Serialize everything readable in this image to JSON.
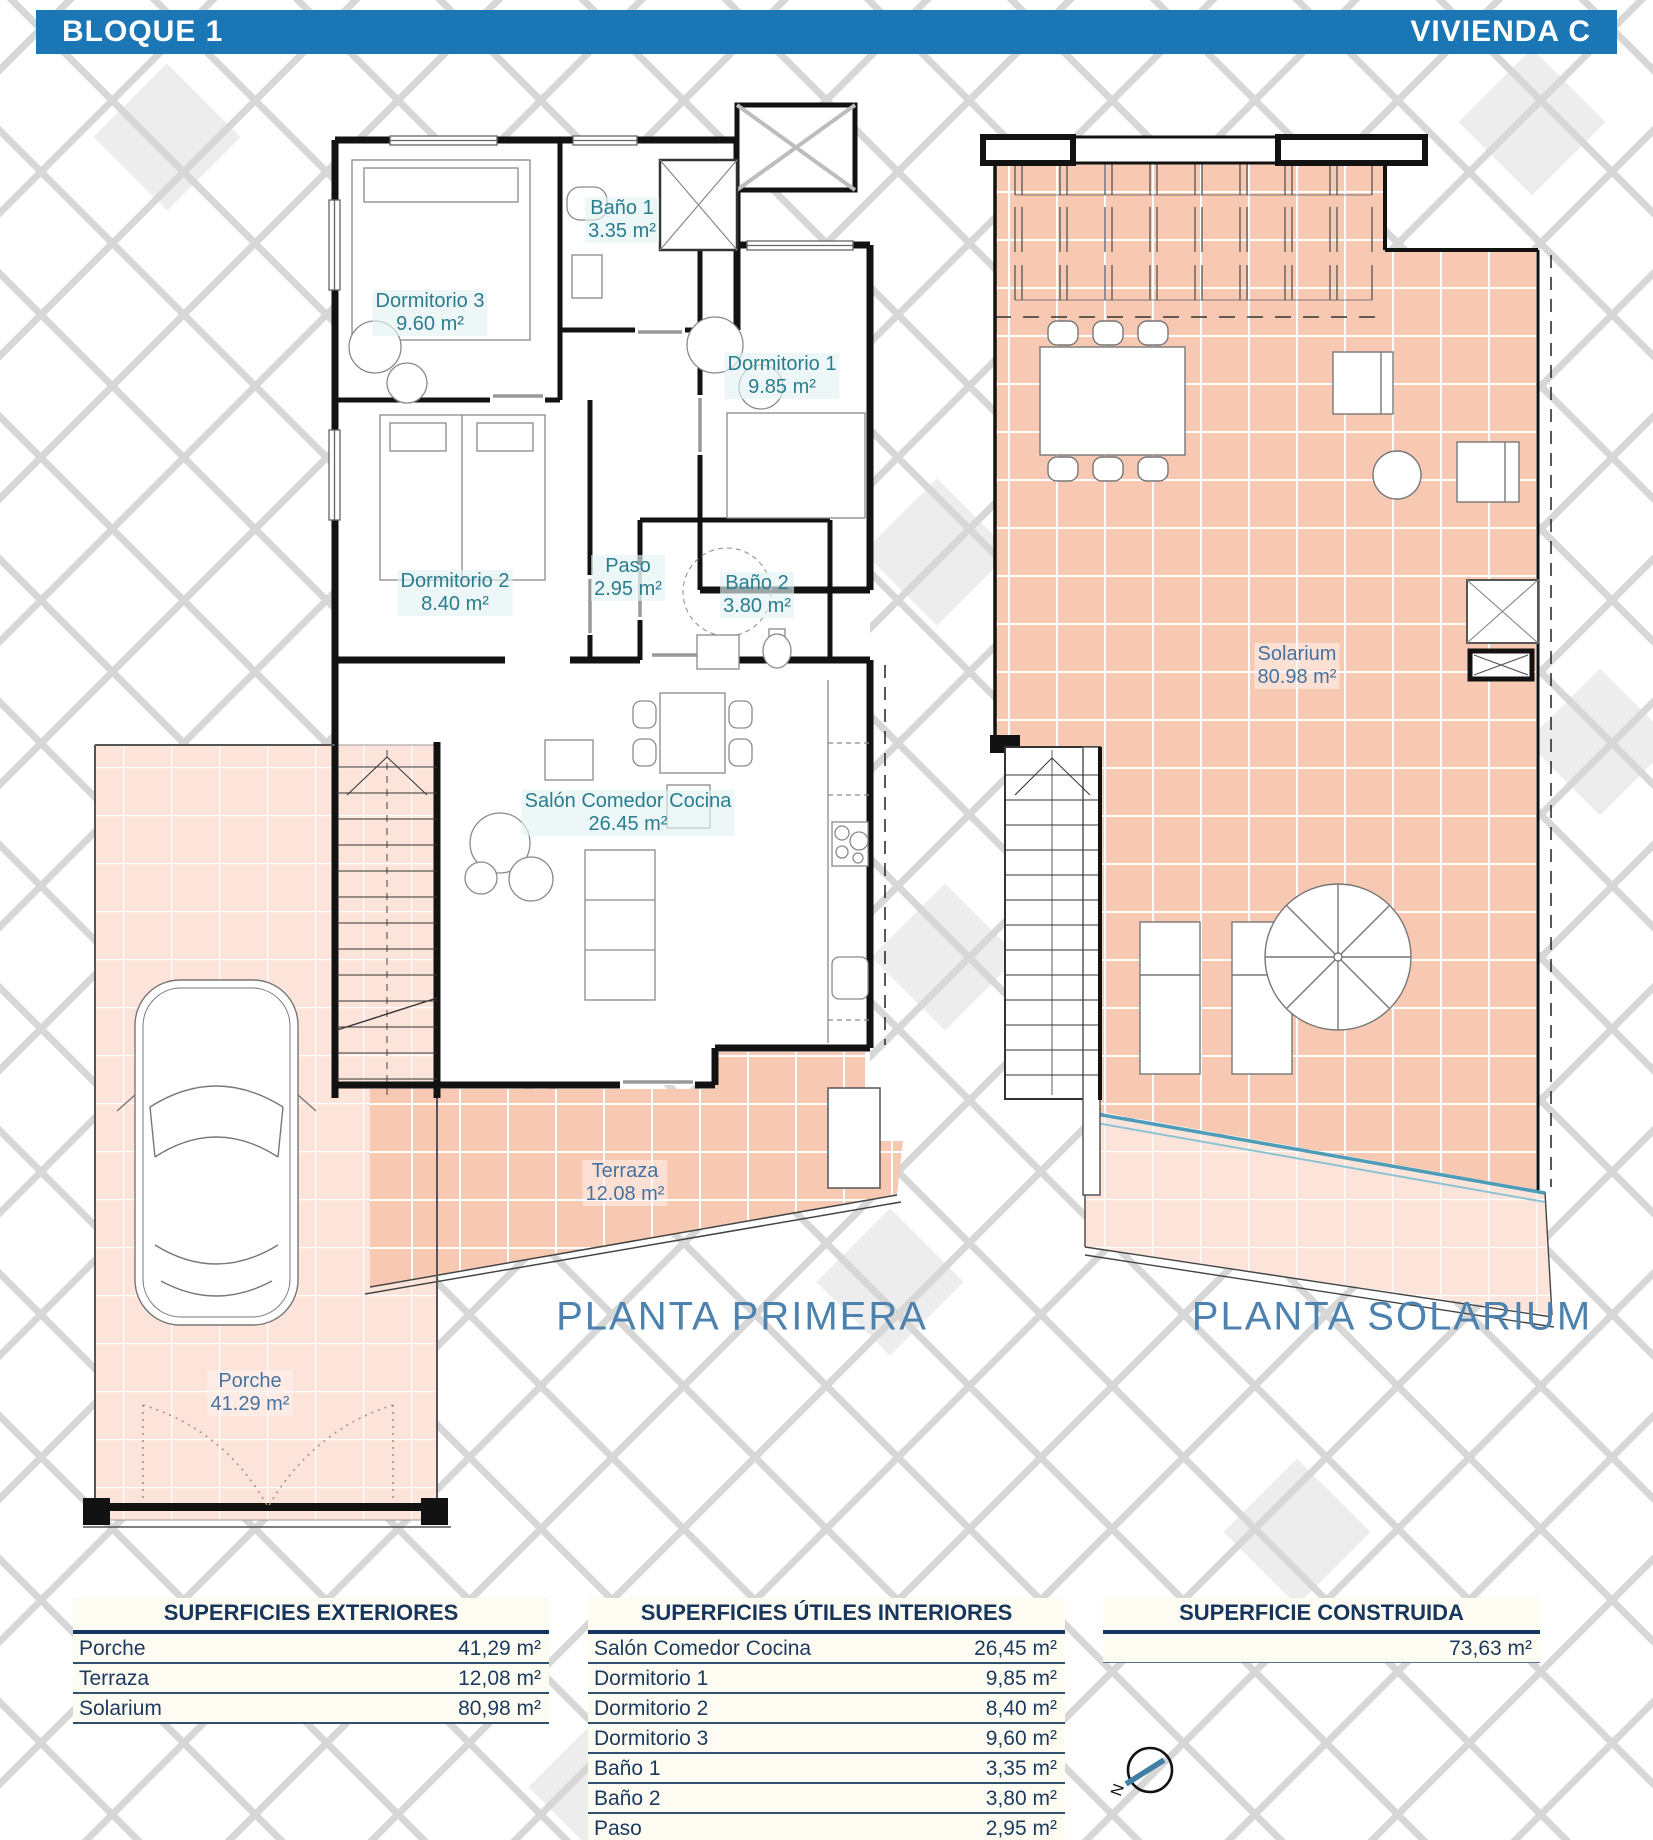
{
  "header": {
    "left": "BLOQUE 1",
    "right": "VIVIENDA C"
  },
  "plan_primera": {
    "title": "PLANTA PRIMERA",
    "rooms": {
      "bano1": {
        "name": "Baño 1",
        "area": "3.35 m²"
      },
      "dormitorio3": {
        "name": "Dormitorio 3",
        "area": "9.60 m²"
      },
      "dormitorio1": {
        "name": "Dormitorio 1",
        "area": "9.85 m²"
      },
      "dormitorio2": {
        "name": "Dormitorio 2",
        "area": "8.40 m²"
      },
      "paso": {
        "name": "Paso",
        "area": "2.95 m²"
      },
      "bano2": {
        "name": "Baño 2",
        "area": "3.80 m²"
      },
      "salon": {
        "name": "Salón Comedor Cocina",
        "area": "26.45 m²"
      },
      "terraza": {
        "name": "Terraza",
        "area": "12.08 m²"
      },
      "porche": {
        "name": "Porche",
        "area": "41.29 m²"
      }
    }
  },
  "plan_solarium": {
    "title": "PLANTA SOLARIUM",
    "rooms": {
      "solarium": {
        "name": "Solarium",
        "area": "80.98 m²"
      }
    }
  },
  "tables": {
    "exteriores": {
      "title": "SUPERFICIES EXTERIORES",
      "rows": [
        {
          "label": "Porche",
          "value": "41,29 m²"
        },
        {
          "label": "Terraza",
          "value": "12,08 m²"
        },
        {
          "label": "Solarium",
          "value": "80,98 m²"
        }
      ]
    },
    "interiores": {
      "title": "SUPERFICIES ÚTILES INTERIORES",
      "rows": [
        {
          "label": "Salón Comedor Cocina",
          "value": "26,45 m²"
        },
        {
          "label": "Dormitorio 1",
          "value": "9,85 m²"
        },
        {
          "label": "Dormitorio 2",
          "value": "8,40 m²"
        },
        {
          "label": "Dormitorio 3",
          "value": "9,60 m²"
        },
        {
          "label": "Baño 1",
          "value": "3,35 m²"
        },
        {
          "label": "Baño 2",
          "value": "3,80 m²"
        },
        {
          "label": "Paso",
          "value": "2,95 m²"
        }
      ]
    },
    "construida": {
      "title": "SUPERFICIE CONSTRUIDA",
      "rows": [
        {
          "label": "",
          "value": "73,63 m²"
        }
      ]
    }
  },
  "compass": {
    "label": "N"
  },
  "colors": {
    "header_blue": "#1b76b5",
    "room_label_teal": "#2a7d8e",
    "exterior_label_blue": "#47729f",
    "plan_title_blue": "#4d82ae",
    "table_navy": "#17365d",
    "tile_salmon": "#f8c9b2",
    "tile_porch": "#fce4da"
  }
}
